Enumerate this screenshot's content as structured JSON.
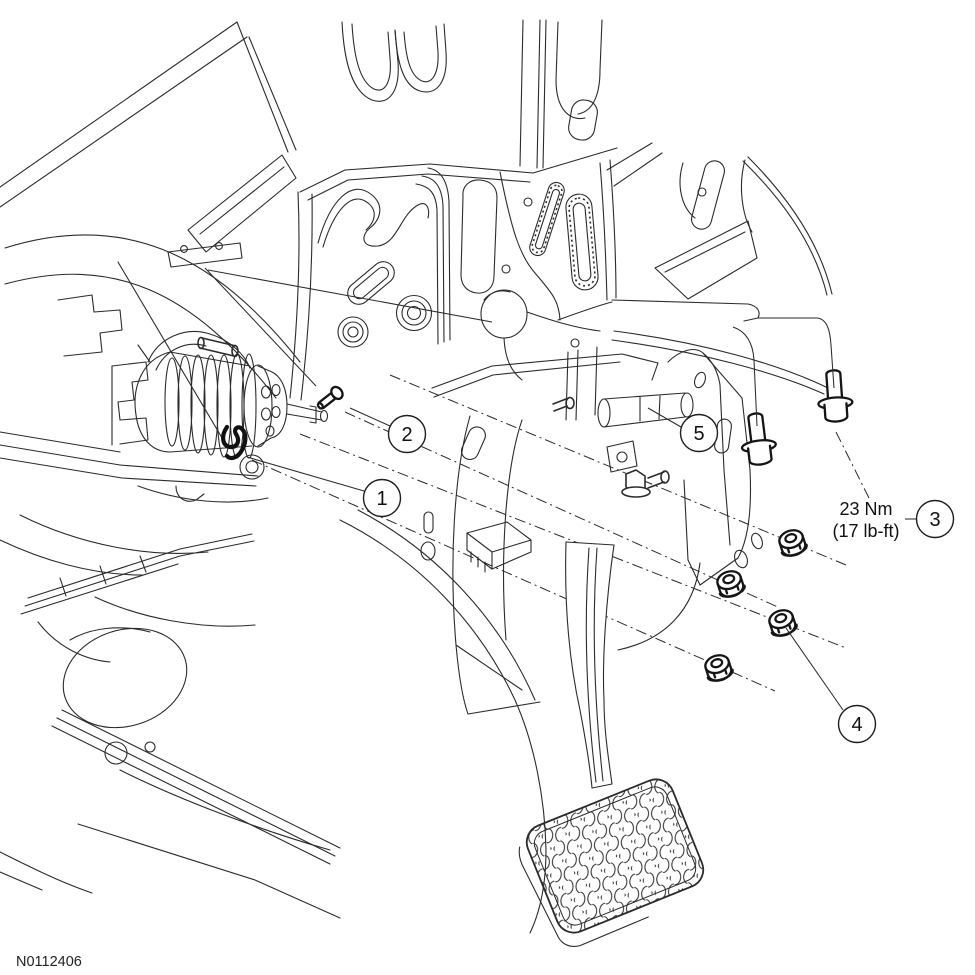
{
  "figure": {
    "id": "N0112406"
  },
  "torque_note": {
    "line1": "23 Nm",
    "line2": "(17 lb-ft)"
  },
  "callouts": {
    "c1": {
      "label": "1"
    },
    "c2": {
      "label": "2"
    },
    "c3": {
      "label": "3"
    },
    "c4": {
      "label": "4"
    },
    "c5": {
      "label": "5"
    }
  },
  "colors": {
    "line": "#2b2b2b",
    "background": "#ffffff"
  }
}
